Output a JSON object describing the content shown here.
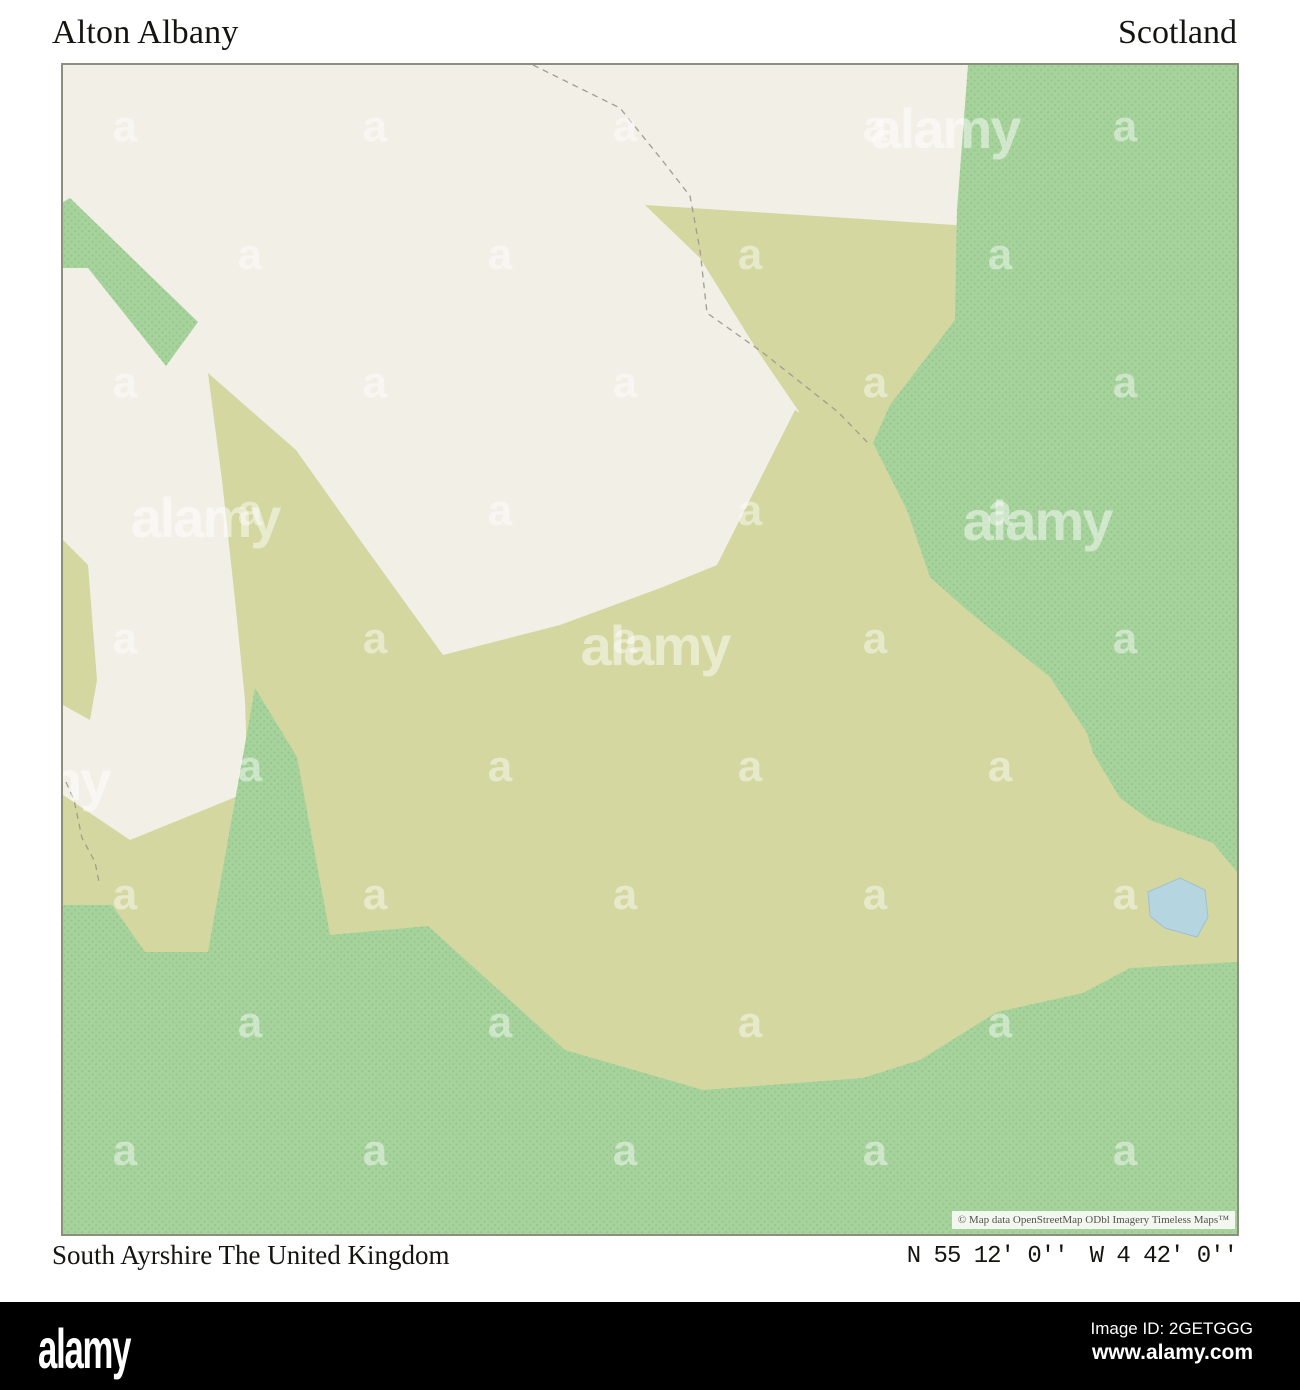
{
  "header": {
    "title": "Alton Albany",
    "region": "Scotland"
  },
  "map": {
    "attribution": "© Map data OpenStreetMap ODbl Imagery Timeless Maps™",
    "watermark": {
      "brand": "alamy",
      "letter": "a"
    },
    "colors": {
      "land": "#f2efe7",
      "scrub": "#d4d7a0",
      "forest": "#a6d29c",
      "forest_dot": "#84ba7c",
      "water": "#b5d5e0",
      "frame": "#8b8f7e",
      "boundary": "#a29d90"
    }
  },
  "footer": {
    "place": "South Ayrshire The United Kingdom",
    "latitude": "N 55 12' 0''",
    "longitude": "W 4 42' 0''"
  },
  "banner": {
    "logo": "alamy",
    "image_id": "Image ID: 2GETGGG",
    "url": "www.alamy.com"
  }
}
